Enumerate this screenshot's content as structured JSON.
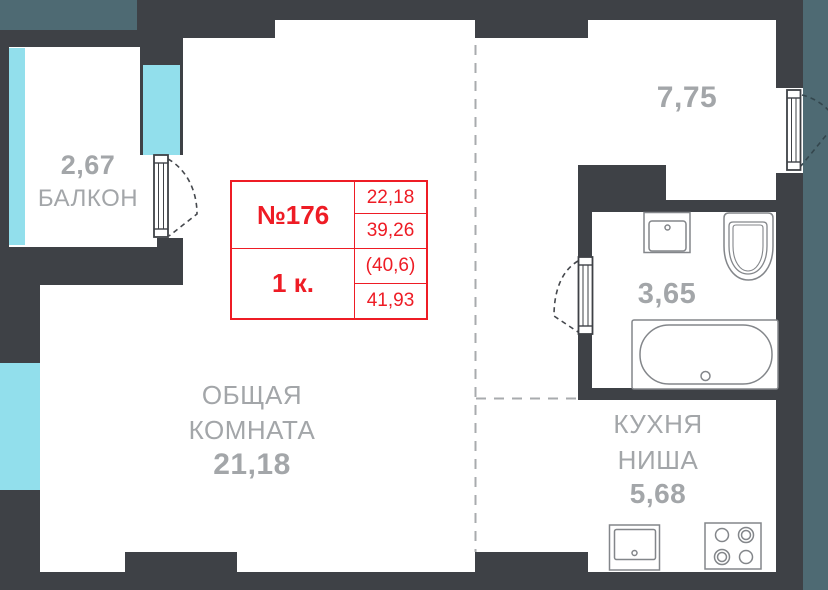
{
  "info_table": {
    "apartment_number": "№176",
    "room_count": "1 к.",
    "values": [
      "22,18",
      "39,26",
      "(40,6)",
      "41,93"
    ],
    "accent_color": "#ee1c25"
  },
  "rooms": {
    "balcony": {
      "name": "БАЛКОН",
      "area": "2,67"
    },
    "living_room": {
      "name": "ОБЩАЯ КОМНАТА",
      "area": "21,18"
    },
    "room_775": {
      "name": "",
      "area": "7,75"
    },
    "bathroom": {
      "name": "",
      "area": "3,65"
    },
    "kitchen": {
      "name": "КУХНЯ НИША",
      "area": "5,68"
    }
  },
  "colors": {
    "wall": "#3e4146",
    "window_glazing": "#92dfec",
    "adjacent_structure": "#4e6a73",
    "label_gray": "#a3a6a9",
    "accent_red": "#ee1c25"
  },
  "icons": {
    "bathtub": "bathtub-icon",
    "toilet": "toilet-icon",
    "bathroom_sink": "sink-icon",
    "kitchen_sink": "kitchen-sink-icon",
    "stove": "stove-burners-icon",
    "doors": "door-swing-icon",
    "divider": "dashed-zone-divider"
  }
}
